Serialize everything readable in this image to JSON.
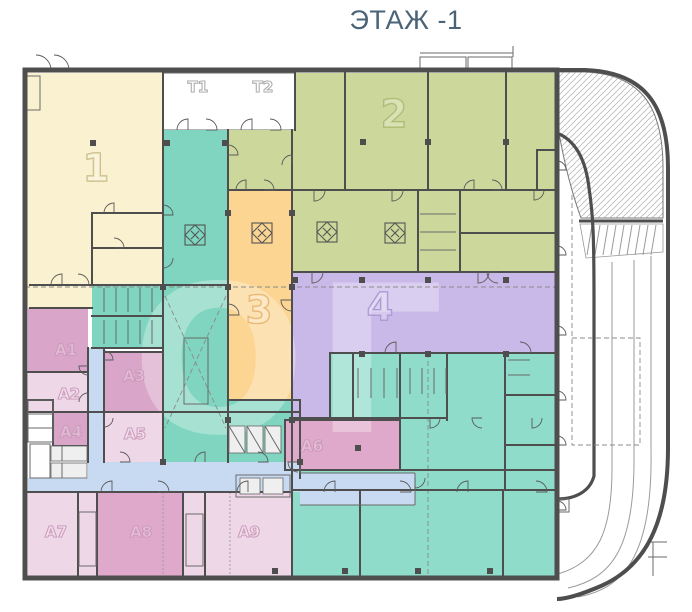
{
  "title": "ЭТАЖ -1",
  "watermark": "ОГ",
  "zones": {
    "z1": {
      "label": "1",
      "color": "#f9f1cf"
    },
    "z2": {
      "label": "2",
      "color": "#ccd89b"
    },
    "z3": {
      "label": "3",
      "color": "#fcd592"
    },
    "z4": {
      "label": "4",
      "color": "#c9b9e9"
    },
    "t1": {
      "label": "T1",
      "color": "#ffffff"
    },
    "t2": {
      "label": "T2",
      "color": "#ffffff"
    },
    "a1": {
      "label": "A1",
      "color": "#d9a6c9"
    },
    "a2": {
      "label": "A2",
      "color": "#eed8e8"
    },
    "a3": {
      "label": "A3",
      "color": "#d9a6c9"
    },
    "a4": {
      "label": "A4",
      "color": "#d9a6c9"
    },
    "a5": {
      "label": "A5",
      "color": "#eed8e8"
    },
    "a6": {
      "label": "A6",
      "color": "#dfa9cb"
    },
    "a7": {
      "label": "A7",
      "color": "#eed8e8"
    },
    "a8": {
      "label": "A8",
      "color": "#dfa9cb"
    },
    "a9": {
      "label": "A9",
      "color": "#eed8e8"
    }
  },
  "colors": {
    "wall": "#4e4e4e",
    "corridor": "#c8daf2",
    "teal": "#7fd5bf",
    "teal_light": "#8edcc9",
    "core_gray": "#dcdcdc",
    "title_text": "#4a6377"
  }
}
